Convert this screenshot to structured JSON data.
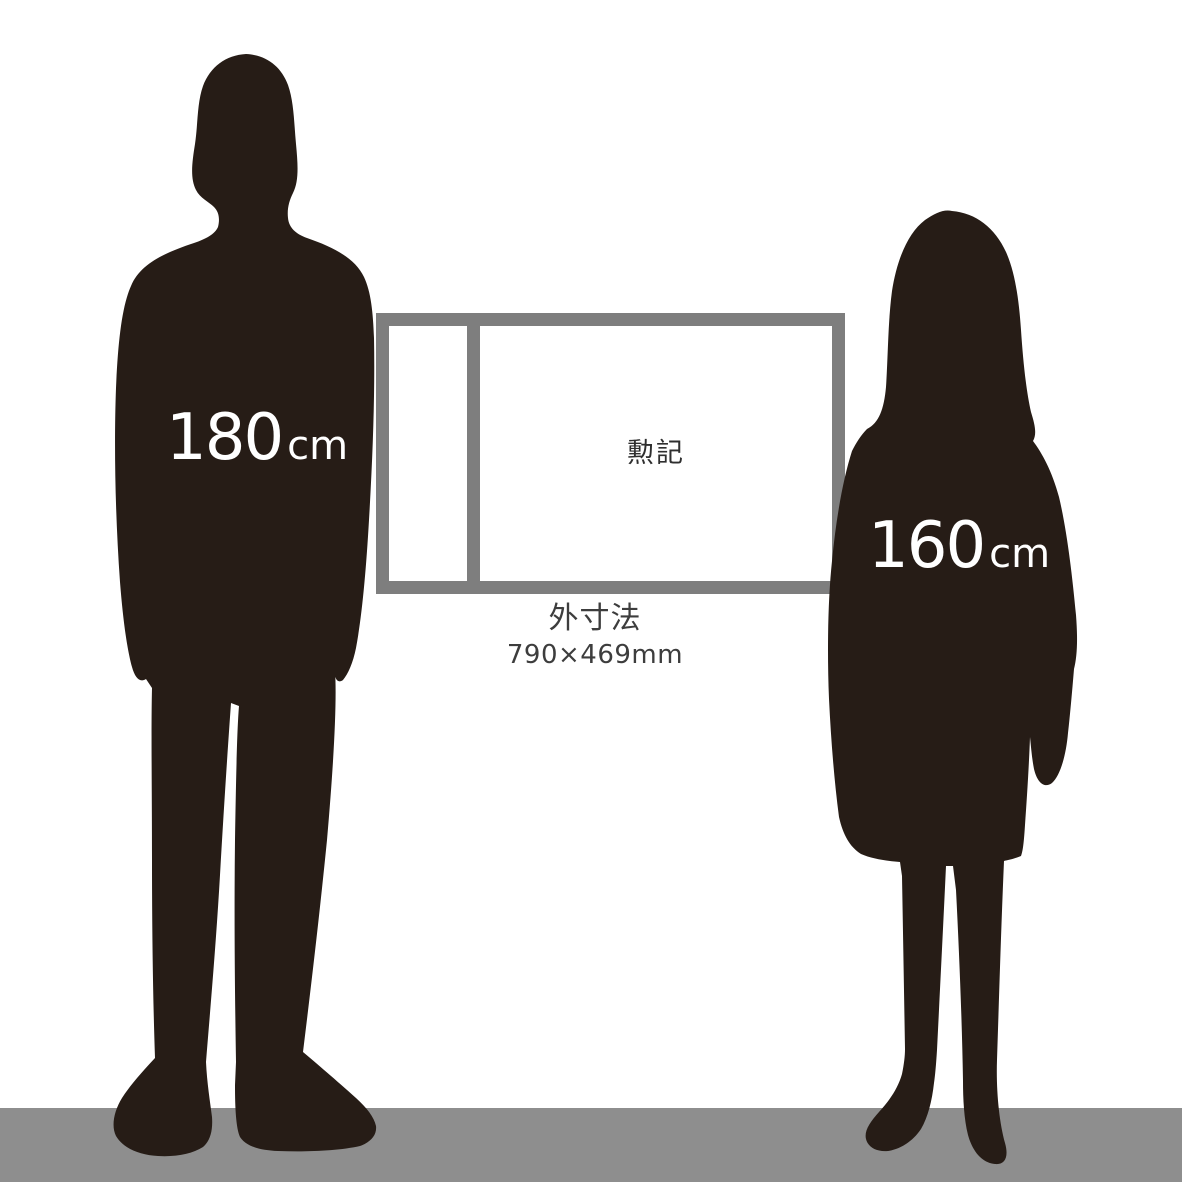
{
  "figures": {
    "male": {
      "height": "180",
      "unit": "cm"
    },
    "female": {
      "height": "160",
      "unit": "cm"
    }
  },
  "product": {
    "label": "勲記",
    "dimension_title": "外寸法",
    "dimension_value": "790×469mm"
  },
  "colors": {
    "background": "#ffffff",
    "silhouette": "#261c16",
    "frame_border": "#7e7e7e",
    "floor": "#8e8e8e",
    "height_label_text": "#ffffff",
    "caption_text": "#3d3d3d",
    "certificate_label_text": "#2f2f2f"
  }
}
